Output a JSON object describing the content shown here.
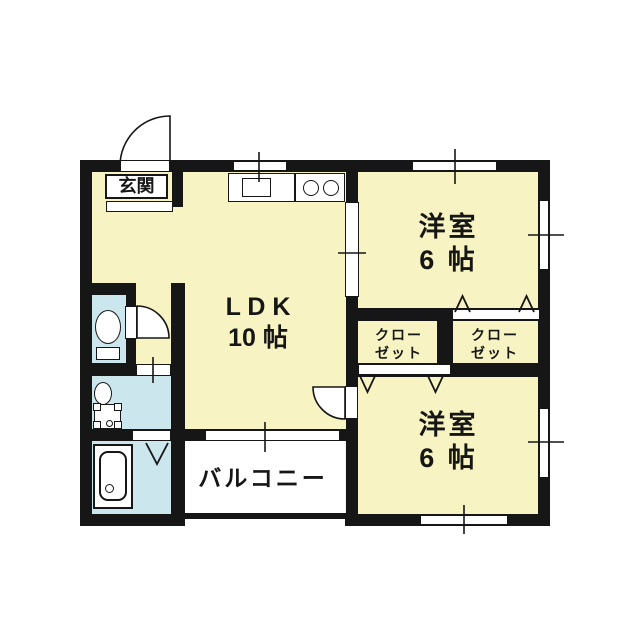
{
  "canvas": {
    "background": "#FFFFFF"
  },
  "colors": {
    "wall": "#161616",
    "room_fill": "#F7F3C2",
    "wet_area_fill": "#CCE6EE",
    "balcony_fill": "#FFFFFF",
    "line": "#161616"
  },
  "rooms": {
    "genkan": {
      "label": "玄関"
    },
    "ldk": {
      "name_line": "L D K",
      "size_line": "10 帖"
    },
    "bedroom_top": {
      "name_line": "洋室",
      "size_line": "6 帖"
    },
    "bedroom_bottom": {
      "name_line": "洋室",
      "size_line": "6 帖"
    },
    "closet_left": {
      "line1": "クロー",
      "line2": "ゼット"
    },
    "closet_right": {
      "line1": "クロー",
      "line2": "ゼット"
    },
    "balcony": {
      "label": "バルコニー"
    }
  },
  "fixtures": {
    "kitchen_counter": "kitchen-counter",
    "sink": "kitchen-sink",
    "stove": "stove-two-burners",
    "toilet": "toilet",
    "washbasin": "washbasin",
    "washer_pan": "washing-machine-pan",
    "bathtub": "bathtub"
  }
}
